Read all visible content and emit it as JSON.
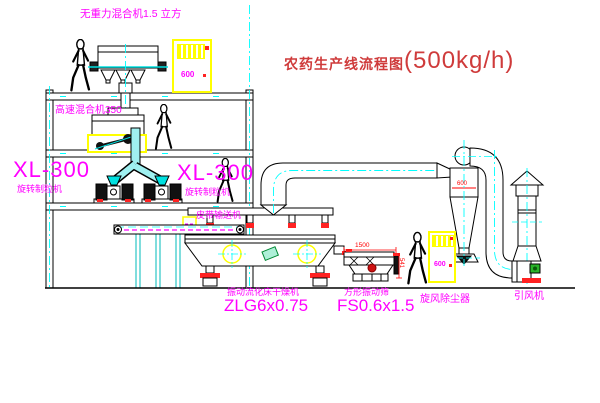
{
  "diagram": {
    "title": "农药生产线流程图",
    "capacity": "(500kg/h)"
  },
  "labels": {
    "gravity_mixer": "无重力混合机1.5 立方",
    "high_speed_mixer": "高速混合机350",
    "granulator_left": {
      "model": "XL-300",
      "name": "旋转制粒机"
    },
    "granulator_center": {
      "model": "XL-300",
      "name": "旋转制粒机"
    },
    "belt_conveyor": "皮带输送机",
    "dryer": {
      "name": "振动流化床干燥机",
      "model": "ZLG6x0.75"
    },
    "screen": {
      "name": "方形振动筛",
      "model": "FS0.6x1.5"
    },
    "cyclone": "旋风除尘器",
    "fan": "引风机"
  },
  "dimensions": {
    "cyclone_width": "600",
    "screen_length": "1500",
    "screen_height": "541"
  },
  "control_cabinets": {
    "upper": "600",
    "lower": "600"
  },
  "colors": {
    "label_magenta": "#ff00ff",
    "title_red": "#cf3b3b",
    "dimension_red": "#ff0000",
    "centerline_cyan": "#00ffff",
    "equipment_yellow": "#ffff00",
    "motor_green": "#22aa22",
    "line_black": "#000000",
    "background": "#ffffff"
  },
  "icons": {
    "person": "walking-person-icon",
    "crosshair": "crosshair-circle-icon"
  }
}
